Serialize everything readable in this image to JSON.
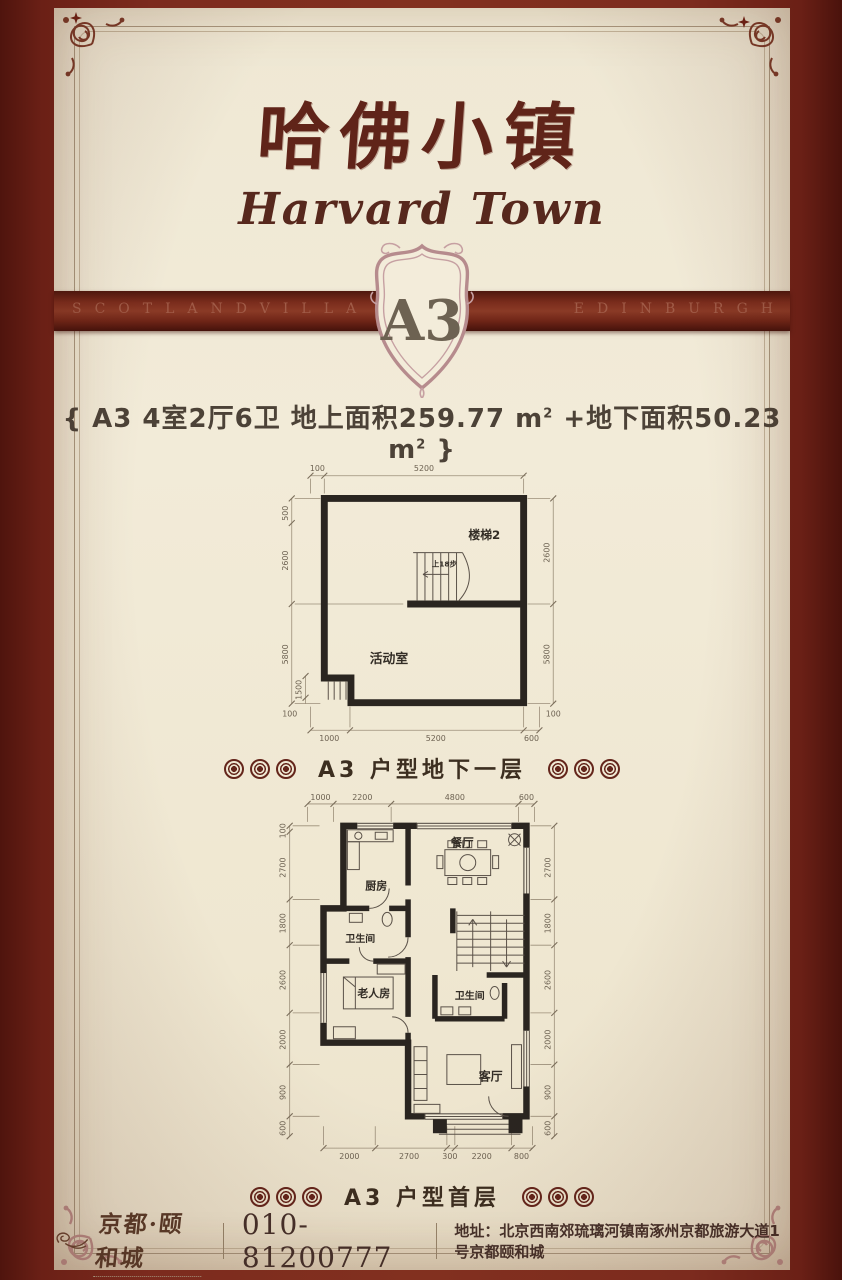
{
  "colors": {
    "page_bg": "#7c2b1e",
    "card_bg": "#f1ead6",
    "accent_dark_red": "#602419",
    "band_red": "#6f2517",
    "wall_black": "#2a2520",
    "dim_gray": "#9b8e79",
    "rosette_red": "#64251b"
  },
  "header": {
    "title_cn": "哈佛小镇",
    "title_en": "Harvard Town",
    "band_left": "SCOTLANDVILLA",
    "band_right": "EDINBURGH",
    "badge": "A3"
  },
  "spec": {
    "p1": "{ A3  4室2厅6卫  地上面积259.77 m",
    "s1": "2",
    "p2": " +地下面积50.23 m",
    "s2": "2",
    "p3": " }"
  },
  "basement": {
    "caption": "A3 户型地下一层",
    "rooms": {
      "stair": "楼梯2",
      "stair_note": "上18步",
      "activity": "活动室"
    },
    "dims": {
      "top": [
        "100",
        "5200"
      ],
      "bottom": [
        "1000",
        "5200",
        "600"
      ],
      "left": [
        "500",
        "2600",
        "5800",
        "1500",
        "100"
      ],
      "right": [
        "2600",
        "5800",
        "100"
      ]
    }
  },
  "first_floor": {
    "caption": "A3 户型首层",
    "rooms": {
      "kitchen": "厨房",
      "dining": "餐厅",
      "bath1": "卫生间",
      "elder": "老人房",
      "bath2": "卫生间",
      "living": "客厅"
    },
    "dims": {
      "top": [
        "1000",
        "2200",
        "4800",
        "600"
      ],
      "bottom": [
        "2000",
        "2700",
        "300",
        "2200",
        "800"
      ],
      "left": [
        "100",
        "2700",
        "1800",
        "2600",
        "2000",
        "900",
        "600"
      ],
      "right": [
        "2700",
        "1800",
        "2600",
        "2000",
        "900",
        "600"
      ]
    }
  },
  "footer": {
    "brand": "京都·颐和城",
    "phone": "010-81200777",
    "address_label": "地址：",
    "address": "北京西南郊琉璃河镇南涿州京都旅游大道1号京都颐和城"
  }
}
